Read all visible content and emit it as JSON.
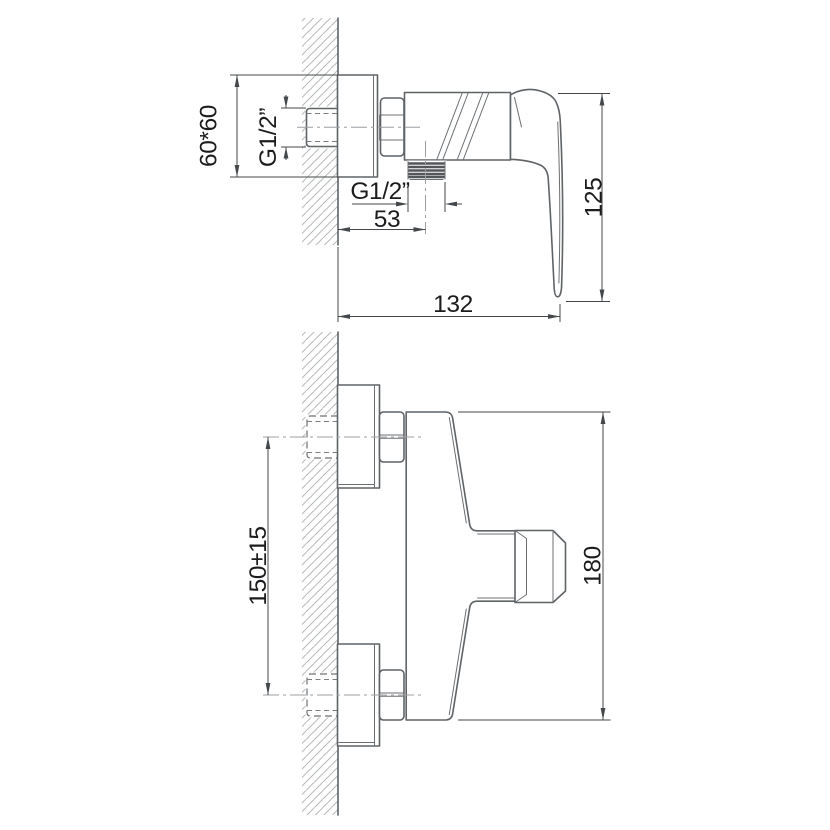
{
  "colors": {
    "background": "#ffffff",
    "part_outline": "#5f6366",
    "hatch": "#b6b9bc",
    "centerline": "#9b9fa2",
    "dimension": "#45484a",
    "text": "#1c1c1e"
  },
  "views": {
    "side": {
      "dimensions": {
        "plate": "60*60",
        "inlet_thread": "G1/2”",
        "outlet_thread": "G1/2”",
        "outlet_offset": "53",
        "total_depth": "132",
        "handle_drop": "125"
      }
    },
    "front": {
      "dimensions": {
        "inlet_spacing": "150±15",
        "total_height": "180"
      }
    }
  }
}
